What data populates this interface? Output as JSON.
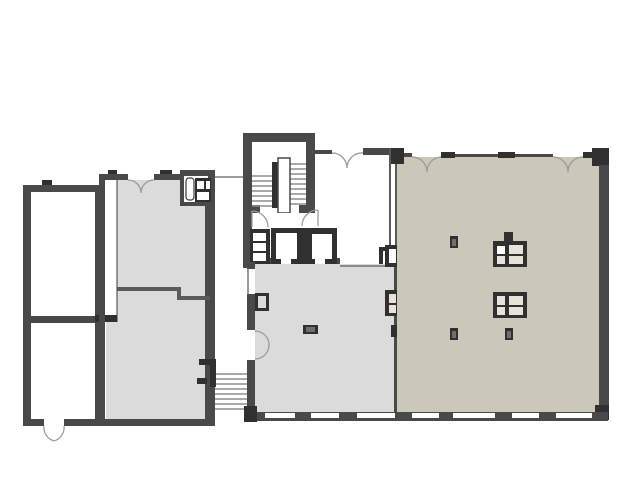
{
  "colors": {
    "background": "#ffffff",
    "wall": "#494949",
    "wall_dark": "#303030",
    "partition": "#5a5a5a",
    "line": "#3a3a3a",
    "floor_white": "#ffffff",
    "floor_gray": "#dbdbdb",
    "floor_tan": "#cbc8ba",
    "stair_tread": "#8e8e8e",
    "door_arc": "#9b9b9b",
    "fixture_fill": "#e6e4da",
    "fixture_cell_white": "#ffffff",
    "column_inner": "#6f6f6f"
  }
}
